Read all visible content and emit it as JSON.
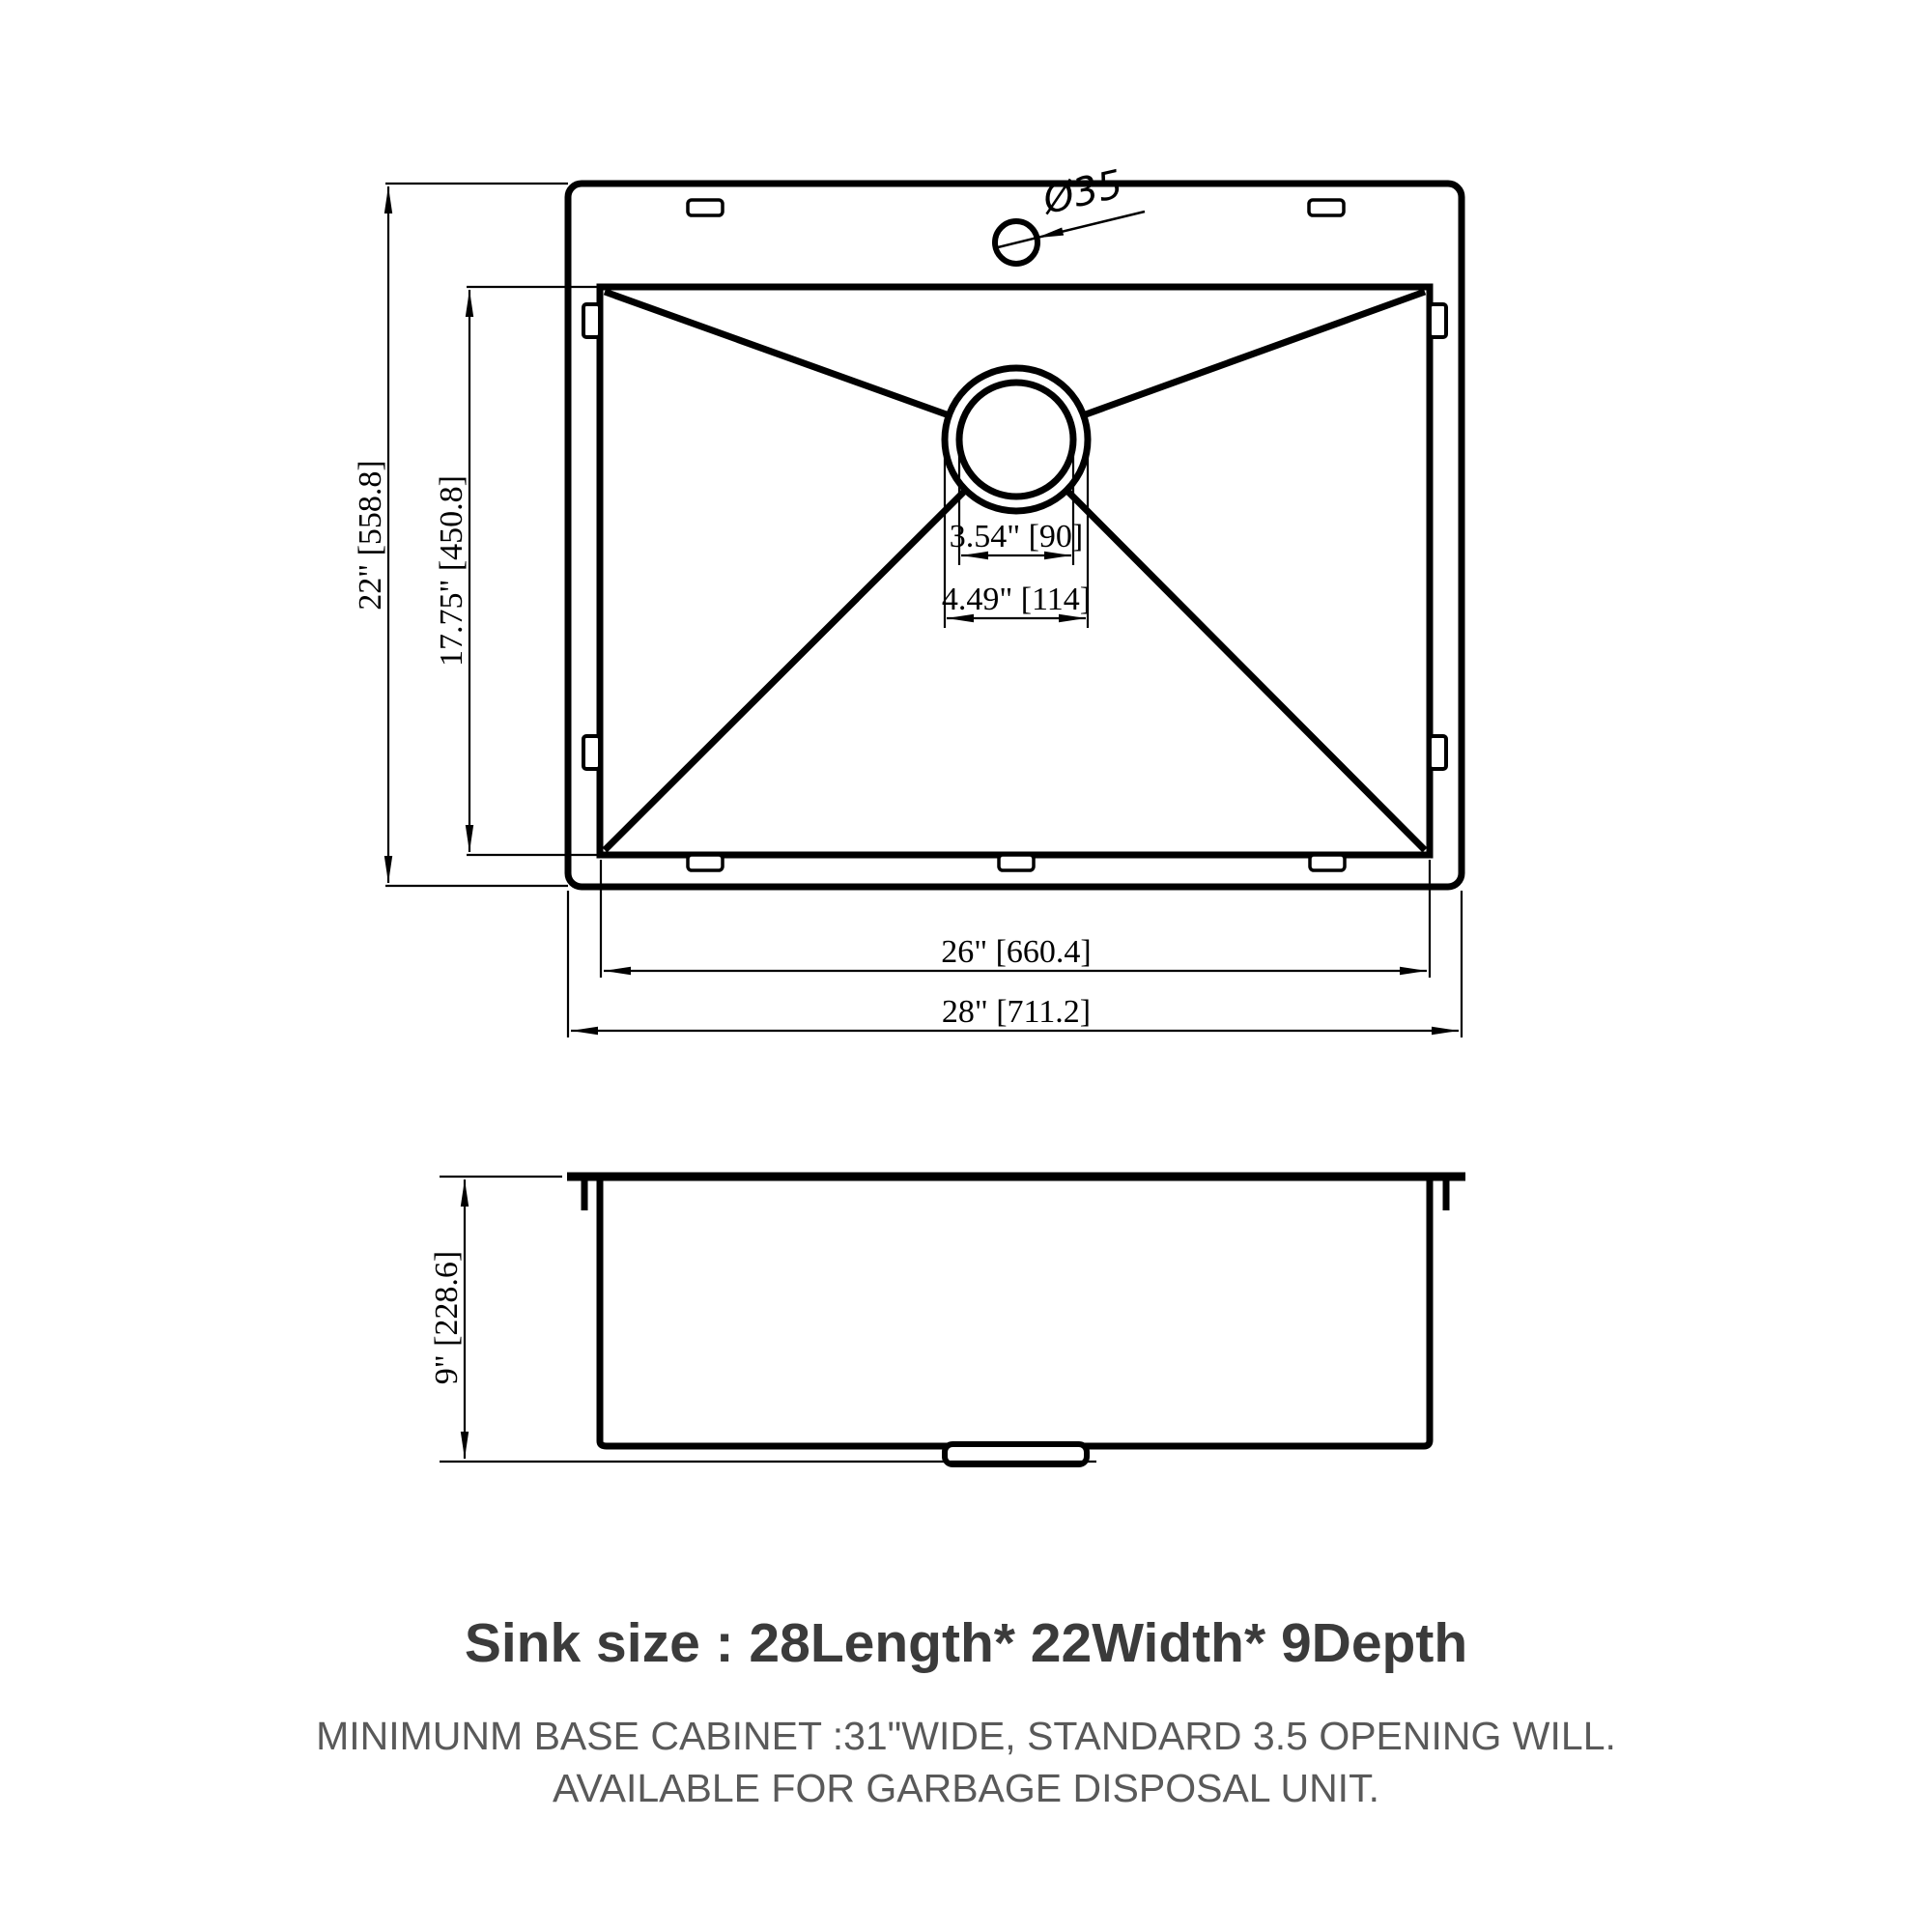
{
  "drawing": {
    "top_view": {
      "faucet_hole_label": "Ø35",
      "overall_width_label": "22\" [558.8]",
      "bowl_width_label": "17.75\" [450.8]",
      "drain_inner_diameter_label": "3.54\" [90]",
      "drain_outer_diameter_label": "4.49\" [114]",
      "bowl_length_label": "26\" [660.4]",
      "overall_length_label": "28\" [711.2]"
    },
    "side_view": {
      "depth_label": "9\" [228.6]"
    }
  },
  "caption": {
    "title": "Sink size :  28Length* 22Width* 9Depth",
    "note_line1": "MINIMUNM BASE CABINET :31\"WIDE,  STANDARD 3.5 OPENING WILL.",
    "note_line2": "AVAILABLE FOR GARBAGE DISPOSAL UNIT."
  },
  "colors": {
    "line": "#000000",
    "title_text": "#3b3b3b",
    "note_text": "#595959"
  }
}
